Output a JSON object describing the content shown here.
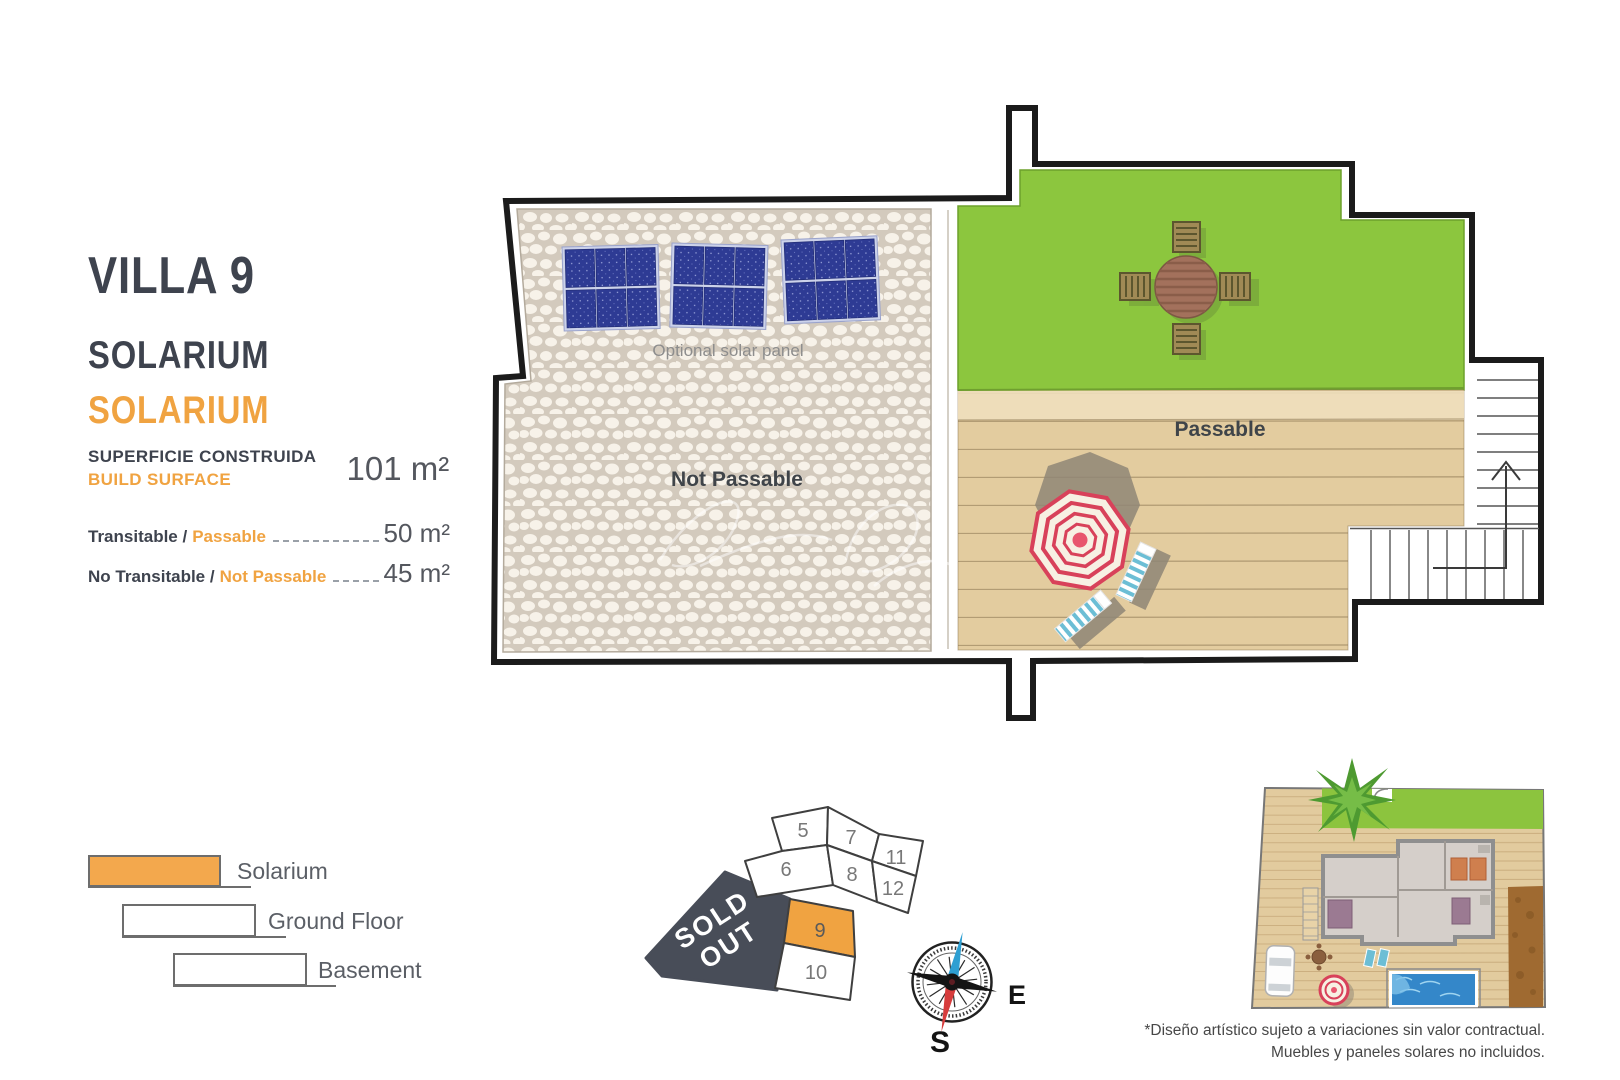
{
  "page": {
    "title": "VILLA 9",
    "floor_name": "SOLARIUM",
    "floor_name_translation": "SOLARIUM"
  },
  "surface": {
    "label_primary": "SUPERFICIE CONSTRUIDA",
    "label_secondary": "BUILD SURFACE",
    "value": "101 m²"
  },
  "areas": [
    {
      "label_primary": "Transitable /",
      "label_accent": "Passable",
      "value": "50 m²"
    },
    {
      "label_primary": "No Transitable /",
      "label_accent": "Not Passable",
      "value": "45 m²"
    }
  ],
  "plan": {
    "not_passable_label": "Not Passable",
    "passable_label": "Passable",
    "solar_note": "Optional solar panel"
  },
  "legend": {
    "items": [
      {
        "label": "Solarium",
        "color": "#f3a84d"
      },
      {
        "label": "Ground Floor",
        "color": "#ffffff"
      },
      {
        "label": "Basement",
        "color": "#ffffff"
      }
    ]
  },
  "plot_map": {
    "sold_out_line1": "SOLD",
    "sold_out_line2": "OUT",
    "highlighted_plot": "9",
    "highlight_color": "#f0a341",
    "sold_color": "#484d58",
    "plots": [
      {
        "id": "5"
      },
      {
        "id": "6"
      },
      {
        "id": "7"
      },
      {
        "id": "8"
      },
      {
        "id": "11"
      },
      {
        "id": "12"
      },
      {
        "id": "9"
      },
      {
        "id": "10"
      }
    ]
  },
  "compass": {
    "east": "E",
    "south": "S"
  },
  "disclaimer": {
    "line1": "*Diseño artístico sujeto a variaciones sin valor contractual.",
    "line2": "Muebles y paneles solares no incluidos."
  },
  "colors": {
    "accent": "#f0a341",
    "lawn_green": "#8cc63e",
    "deck_tan": "#e3cc9f",
    "solar_blue": "#2e3b94",
    "umbrella_red": "#d8415a"
  }
}
